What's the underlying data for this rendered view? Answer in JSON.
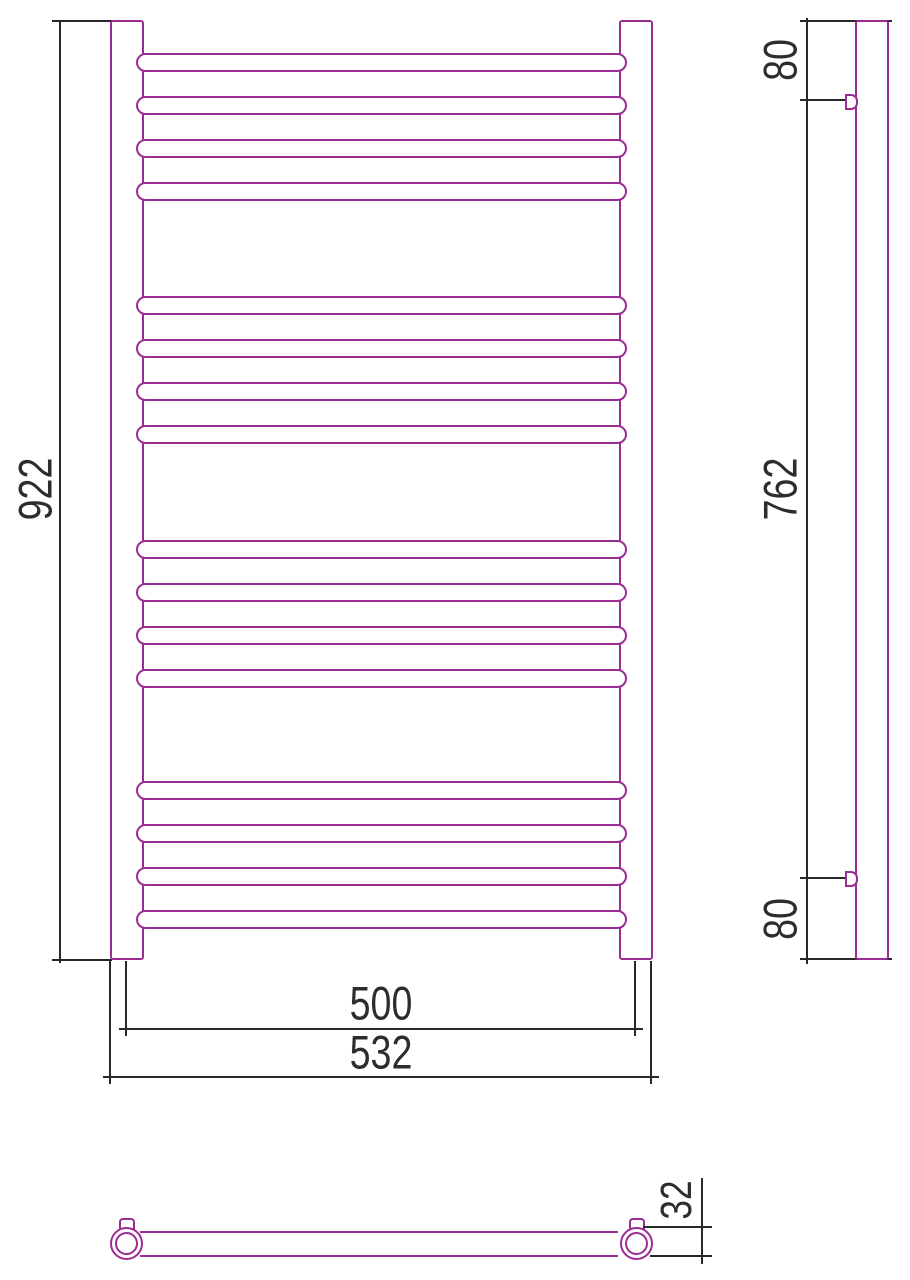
{
  "drawing": {
    "kind": "heated-towel-rail-technical-drawing",
    "colors": {
      "outline": "#9A2C94",
      "dimension_lines": "#282828",
      "text": "#2D2D2D",
      "background": "#FFFFFF"
    },
    "front_view": {
      "height_label": "922",
      "rail_spacing_label": "500",
      "overall_width_label": "532",
      "bar_count": 16,
      "bar_geometry": {
        "left": 136,
        "width": 491,
        "height": 19,
        "tops": [
          53,
          96,
          139,
          182,
          296,
          339,
          382,
          425,
          540,
          583,
          626,
          669,
          781,
          824,
          867,
          910
        ]
      }
    },
    "side_view": {
      "top_offset_label": "80",
      "bracket_span_label": "762",
      "bottom_offset_label": "80"
    },
    "bottom_view": {
      "tube_diameter_label": "32"
    }
  }
}
